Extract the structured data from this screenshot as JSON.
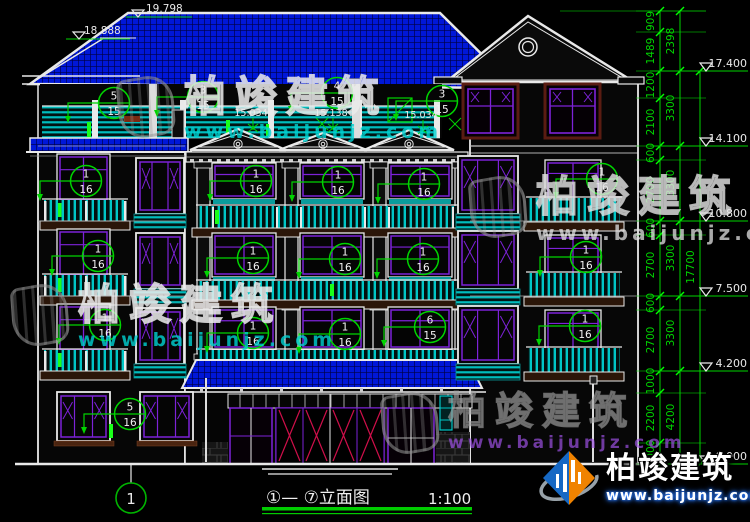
{
  "drawing": {
    "title": "①— ⑦立面图",
    "scale": "1:100",
    "axis_label": "1",
    "ridge_marks": [
      {
        "v": "19.798",
        "tx": 146,
        "ty": 12,
        "ly": 17,
        "lx1": 126,
        "lx2": 192,
        "ax": 138
      },
      {
        "v": "18.888",
        "tx": 84,
        "ty": 34,
        "ly": 39,
        "lx1": 66,
        "lx2": 130,
        "ax": 79
      }
    ],
    "terrace_marks": [
      {
        "v": "15.034",
        "x": 251,
        "y": 116
      },
      {
        "v": "15.138",
        "x": 331,
        "y": 116
      },
      {
        "v": "15.034",
        "x": 421,
        "y": 118
      }
    ],
    "elevation_marks": [
      {
        "v": "17.400",
        "y": 71
      },
      {
        "v": "14.100",
        "y": 146
      },
      {
        "v": "10.800",
        "y": 221
      },
      {
        "v": "7.500",
        "y": 296
      },
      {
        "v": "4.200",
        "y": 371
      },
      {
        "v": "±0.000",
        "y": 464
      }
    ],
    "dims_inner": [
      {
        "v": "909",
        "y": 21
      },
      {
        "v": "1489",
        "y": 51
      },
      {
        "v": "1200",
        "y": 85
      },
      {
        "v": "2100",
        "y": 122
      },
      {
        "v": "600",
        "y": 153
      },
      {
        "v": "2700",
        "y": 190
      },
      {
        "v": "600",
        "y": 228
      },
      {
        "v": "2700",
        "y": 265
      },
      {
        "v": "600",
        "y": 303
      },
      {
        "v": "2700",
        "y": 340
      },
      {
        "v": "1000",
        "y": 381
      },
      {
        "v": "2200",
        "y": 418
      },
      {
        "v": "1000",
        "y": 453
      }
    ],
    "dims_mid": [
      {
        "v": "2398",
        "y": 41
      },
      {
        "v": "3300",
        "y": 108
      },
      {
        "v": "3300",
        "y": 183
      },
      {
        "v": "3300",
        "y": 258
      },
      {
        "v": "3300",
        "y": 333
      },
      {
        "v": "4200",
        "y": 417
      }
    ],
    "dim_total": {
      "v": "17700",
      "y": 267
    },
    "dim_boundaries": {
      "inner": [
        11,
        32,
        71,
        98,
        146,
        160,
        221,
        235,
        296,
        310,
        371,
        393,
        443,
        464
      ],
      "mid": [
        11,
        71,
        146,
        221,
        296,
        371,
        464
      ],
      "total": [
        71,
        464
      ]
    },
    "callouts": [
      {
        "num": "5",
        "den": "15",
        "x": 114,
        "y": 103
      },
      {
        "num": "3",
        "den": "15",
        "x": 203,
        "y": 97
      },
      {
        "num": "4",
        "den": "15",
        "x": 337,
        "y": 93
      },
      {
        "num": "3",
        "den": "15",
        "x": 442,
        "y": 101
      },
      {
        "num": "1",
        "den": "16",
        "x": 86,
        "y": 181
      },
      {
        "num": "1",
        "den": "16",
        "x": 256,
        "y": 181
      },
      {
        "num": "1",
        "den": "16",
        "x": 338,
        "y": 182
      },
      {
        "num": "1",
        "den": "16",
        "x": 424,
        "y": 184
      },
      {
        "num": "1",
        "den": "16",
        "x": 602,
        "y": 179
      },
      {
        "num": "1",
        "den": "16",
        "x": 98,
        "y": 256
      },
      {
        "num": "1",
        "den": "16",
        "x": 253,
        "y": 258
      },
      {
        "num": "1",
        "den": "16",
        "x": 345,
        "y": 259
      },
      {
        "num": "1",
        "den": "16",
        "x": 423,
        "y": 259
      },
      {
        "num": "1",
        "den": "16",
        "x": 586,
        "y": 257
      },
      {
        "num": "1",
        "den": "16",
        "x": 105,
        "y": 325
      },
      {
        "num": "1",
        "den": "16",
        "x": 253,
        "y": 333
      },
      {
        "num": "1",
        "den": "16",
        "x": 345,
        "y": 334
      },
      {
        "num": "6",
        "den": "15",
        "x": 430,
        "y": 327
      },
      {
        "num": "1",
        "den": "16",
        "x": 585,
        "y": 326
      },
      {
        "num": "5",
        "den": "16",
        "x": 130,
        "y": 414
      }
    ]
  },
  "watermark": {
    "brand": "柏竣建筑",
    "url": "www.baijunjz.com"
  },
  "brand": {
    "name": "柏竣建筑",
    "url": "www.baijunjz.com"
  },
  "colors": {
    "annotation_green": "#00d400",
    "roof_blue": "#0017d8",
    "window_purple": "#7d22d8",
    "railing_teal": "#00c6c6",
    "door_red": "#cf0f4a",
    "line_white": "#e9e9e9"
  }
}
